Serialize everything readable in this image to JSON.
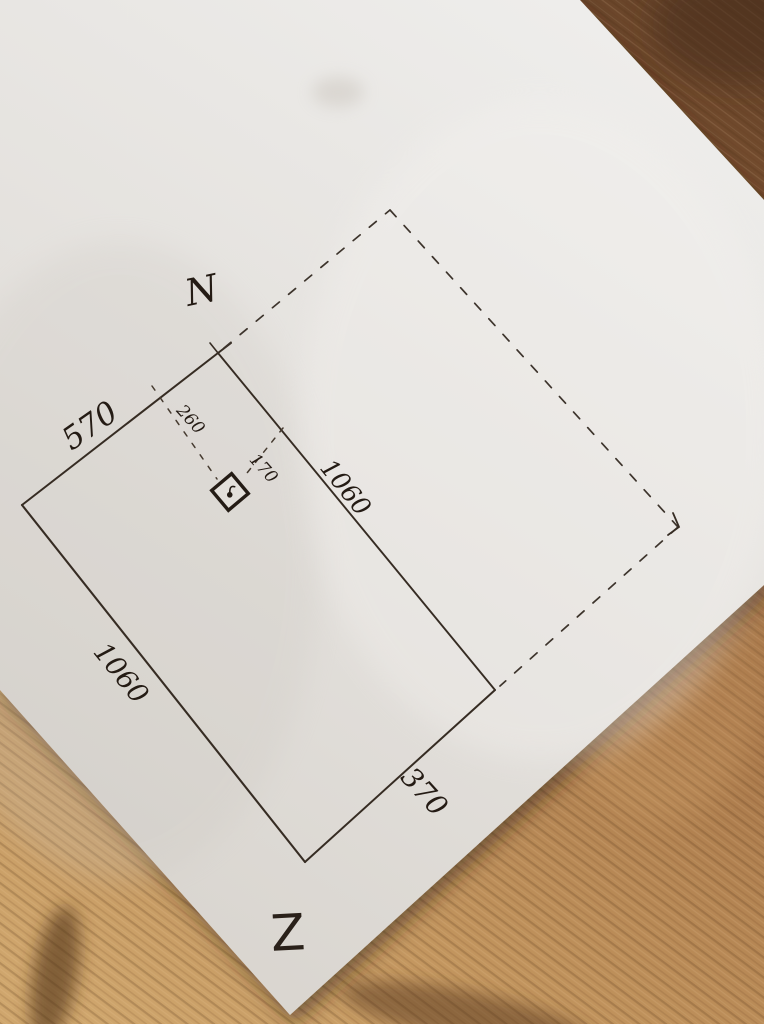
{
  "scene": {
    "description": "Photograph of a hand-drawn land plot sketch in ink on white paper, lying rotated on a wooden table",
    "colors": {
      "paper": "#e6e3df",
      "ink": "#2b221b",
      "wood_dark": "#613f27",
      "wood_mid": "#a9784a",
      "wood_light": "#cda269"
    }
  },
  "sketch": {
    "north_label": "N",
    "corner_letter": "Z",
    "solid_plot_edges": {
      "northwest": "570",
      "southwest": "1060",
      "center_shared": "1060",
      "southeast": "370"
    },
    "dashed_plot": {
      "style": "dashed outline parallelogram, mirror of solid plot"
    },
    "marker": {
      "symbol": "boxed-point-marker",
      "distance_from_northwest_edge": "260",
      "distance_from_center_line": "170"
    }
  }
}
